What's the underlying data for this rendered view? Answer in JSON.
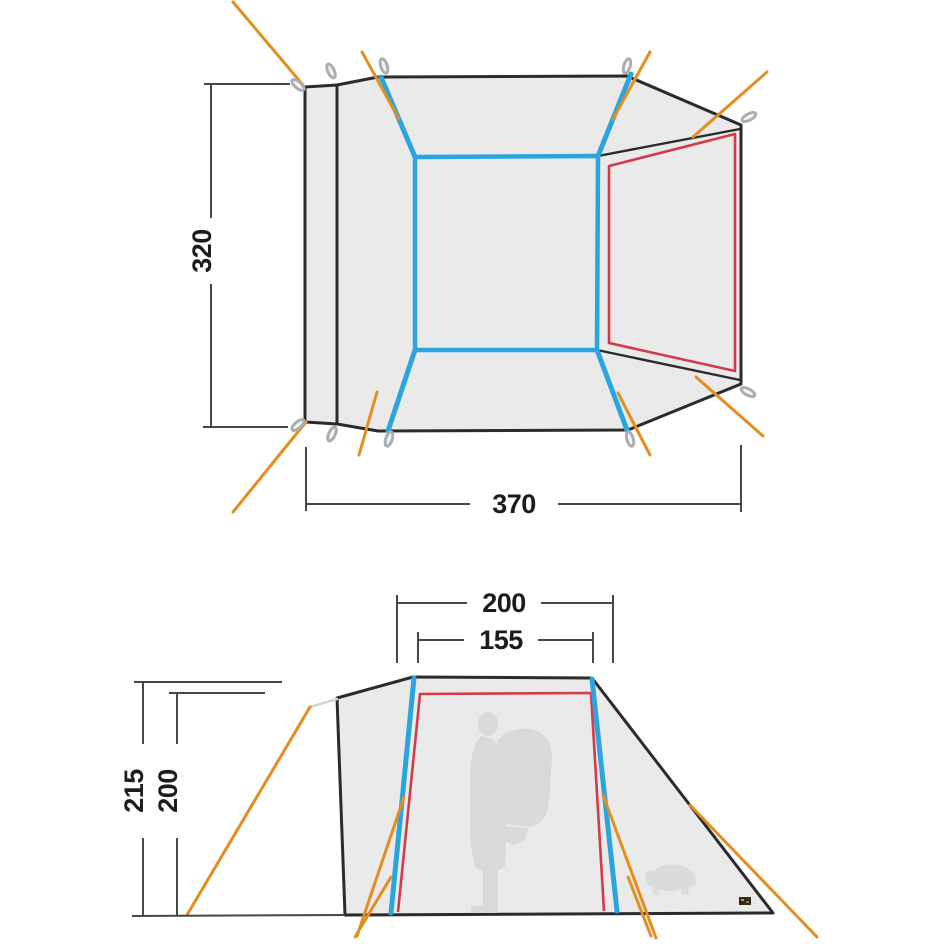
{
  "page": {
    "background": "#ffffff",
    "description_tag": "tent-dimension-diagram"
  },
  "colors": {
    "outline_black": "#2b2b2b",
    "tent_fabric_gray": "#eaeaea",
    "pole_blue": "#2aa5de",
    "inner_tent_red": "#d43b4a",
    "guy_line_orange": "#e38e1e",
    "dimension_line_gray": "#474747",
    "peg_gray": "#abaeb0",
    "silhouette_gray": "#d7d9da",
    "brand_label_brown": "#362a1d"
  },
  "floor_plan": {
    "depth_label": "320",
    "width_label": "370"
  },
  "elevation": {
    "base_width_label": "200",
    "top_width_label": "155",
    "outer_height_label": "215",
    "inner_height_label": "200"
  },
  "icons": {
    "tent_peg": "peg-loop",
    "person": "person-with-backpack-silhouette",
    "buffalo": "buffalo-brand-silhouette",
    "brand_label": "fabric-brand-tab"
  }
}
